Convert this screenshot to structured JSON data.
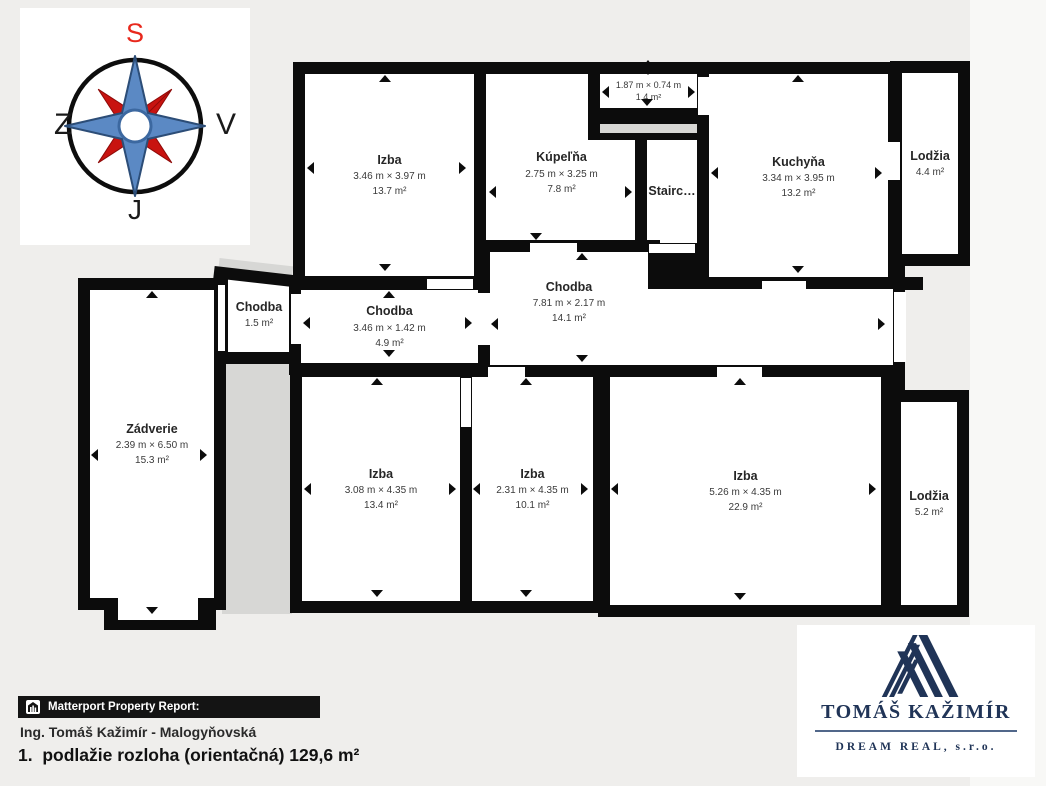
{
  "compass": {
    "north_label": "S",
    "east_label": "V",
    "south_label": "J",
    "west_label": "Z"
  },
  "floorplan": {
    "rooms": {
      "izba_tl": {
        "name": "Izba",
        "dims": "3.46 m × 3.97 m",
        "area": "13.7 m²"
      },
      "kupelna": {
        "name": "Kúpeľňa",
        "dims": "2.75 m × 3.25 m",
        "area": "7.8 m²"
      },
      "nika": {
        "dims": "1.87 m × 0.74 m",
        "area": "1.4 m²"
      },
      "staircase": {
        "name": "Stairc…"
      },
      "kuchyna": {
        "name": "Kuchyňa",
        "dims": "3.34 m × 3.95 m",
        "area": "13.2 m²"
      },
      "lodzia_top": {
        "name": "Lodžia",
        "area": "4.4 m²"
      },
      "chodba_small": {
        "name": "Chodba",
        "area": "1.5 m²"
      },
      "chodba_mid": {
        "name": "Chodba",
        "dims": "3.46 m × 1.42 m",
        "area": "4.9 m²"
      },
      "chodba_main": {
        "name": "Chodba",
        "dims": "7.81 m × 2.17 m",
        "area": "14.1 m²"
      },
      "zadverie": {
        "name": "Zádverie",
        "dims": "2.39 m × 6.50 m",
        "area": "15.3 m²"
      },
      "izba_bl": {
        "name": "Izba",
        "dims": "3.08 m × 4.35 m",
        "area": "13.4 m²"
      },
      "izba_bm": {
        "name": "Izba",
        "dims": "2.31 m × 4.35 m",
        "area": "10.1 m²"
      },
      "izba_br": {
        "name": "Izba",
        "dims": "5.26 m × 4.35 m",
        "area": "22.9 m²"
      },
      "lodzia_bottom": {
        "name": "Lodžia",
        "area": "5.2 m²"
      }
    }
  },
  "footer": {
    "report_label": "Matterport Property Report:",
    "agent": "Ing. Tomáš Kažimír - Malogyňovská",
    "floor_summary": "1.  podlažie rozloha (orientačná) 129,6 m²"
  },
  "logo": {
    "title": "TOMÁŠ KAŽIMÍR",
    "subtitle": "DREAM REAL, s.r.o."
  },
  "colors": {
    "wall": "#0c0c0c",
    "room_fill": "#ffffff",
    "unexplored_gray": "#d7d7d5",
    "compass_blue": "#5b89c4",
    "compass_red": "#c81310",
    "logo_navy": "#203457",
    "report_bar_bg": "#141414"
  }
}
